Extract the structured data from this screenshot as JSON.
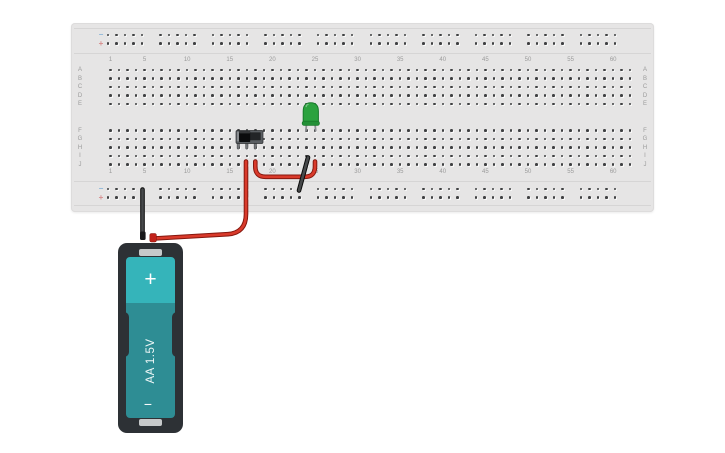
{
  "scene": {
    "background": "#ffffff"
  },
  "breadboard": {
    "column_labels": [
      "1",
      "5",
      "10",
      "15",
      "20",
      "25",
      "30",
      "35",
      "40",
      "45",
      "50",
      "55",
      "60"
    ],
    "column_label_numbers": [
      1,
      5,
      10,
      15,
      20,
      25,
      30,
      35,
      40,
      45,
      50,
      55,
      60
    ],
    "row_labels_upper": [
      "A",
      "B",
      "C",
      "D",
      "E"
    ],
    "row_labels_lower": [
      "F",
      "G",
      "H",
      "I",
      "J"
    ],
    "rail_negative_symbol": "−",
    "rail_positive_symbol": "+",
    "columns": 62,
    "rail_groups": 10,
    "rail_holes_per_group": 5,
    "colors": {
      "board": "#e6e5e5",
      "hole": "#3f4042",
      "label": "#9b9b9b",
      "rail_negative": "#8cb6d8",
      "rail_positive": "#d68c8c",
      "divider": "#d6d5d5"
    }
  },
  "components": {
    "led": {
      "name": "green LED",
      "body_color": "#2ba23e",
      "outline_color": "#187a2a",
      "flange_color": "#239036",
      "leg_color": "#8e9093"
    },
    "slide_switch": {
      "name": "slide switch",
      "body_color": "#5a5e62",
      "recess_color": "#232527",
      "knob_color": "#0b0c0d",
      "track_color": "#8a8d90",
      "leg_color": "#77797c"
    },
    "battery": {
      "type_label": "AA 1.5V",
      "positive_symbol": "+",
      "negative_symbol": "−",
      "holder_color": "#2d3135",
      "cell_top_color": "#35b4ba",
      "cell_bottom_color": "#2e8d94",
      "terminal_color": "#c6c9ca",
      "lead_positive_color": "#c2221a",
      "lead_negative_color": "#17181a"
    }
  },
  "wires": [
    {
      "name": "wire-battery-positive-to-J17",
      "color_core": "#d93a2b",
      "color_outline": "#86170e",
      "path": "M154 238.5 L228 234.2 Q246 232.8 246 214 L246 161.5"
    },
    {
      "name": "wire-switch-J18-to-led-J25",
      "color_core": "#d93a2b",
      "color_outline": "#86170e",
      "path": "M255.3 161.5 L255.3 166.5 Q255.3 176.8 265.5 176.8 L304.8 176.8 Q315 176.8 315 166.5 L315 161.5"
    },
    {
      "name": "wire-battery-negative-to-rail",
      "color_core": "#47494b",
      "color_outline": "#0a0a0a",
      "path": "M142.5 236.5 L142.5 189.5"
    },
    {
      "name": "wire-led-I24-to-negative-rail",
      "color_core": "#47494b",
      "color_outline": "#0a0a0a",
      "path": "M299 190.5 L308 157.5"
    }
  ]
}
